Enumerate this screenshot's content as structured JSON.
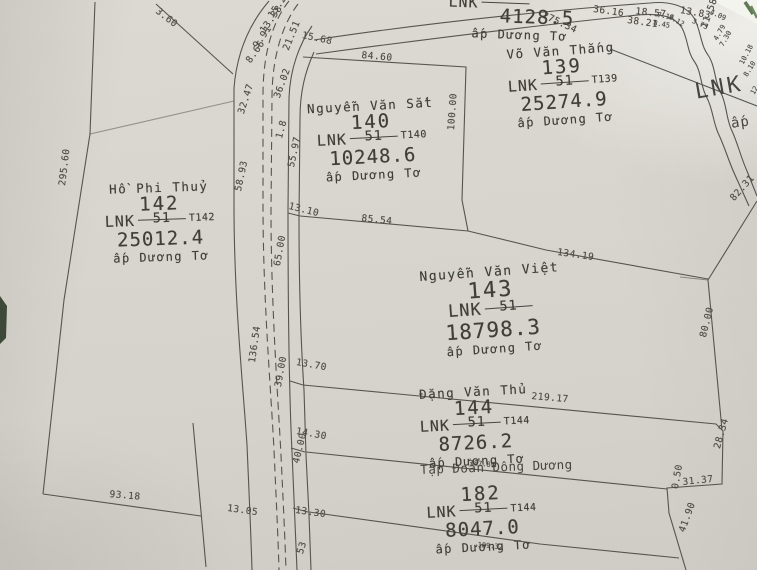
{
  "map": {
    "parcels": [
      {
        "owner": "",
        "number": "",
        "code": "LNK",
        "denom": "",
        "sheet": "",
        "area": "4128.5",
        "hamlet": "ấp Dương Tơ"
      },
      {
        "owner": "Võ Văn Thắng",
        "number": "139",
        "code": "LNK",
        "denom": "51",
        "sheet": "T139",
        "area": "25274.9",
        "hamlet": "ấp Dương Tơ"
      },
      {
        "owner": "Nguyễn Văn Sắt",
        "number": "140",
        "code": "LNK",
        "denom": "51",
        "sheet": "T140",
        "area": "10248.6",
        "hamlet": "ấp Dương Tơ"
      },
      {
        "owner": "Hồ Phi Thuỷ",
        "number": "142",
        "code": "LNK",
        "denom": "51",
        "sheet": "T142",
        "area": "25012.4",
        "hamlet": "ấp Dương Tơ"
      },
      {
        "owner": "Nguyễn Văn Việt",
        "number": "143",
        "code": "LNK",
        "denom": "51",
        "sheet": "",
        "area": "18798.3",
        "hamlet": "ấp Dương Tơ"
      },
      {
        "owner": "Đặng Văn Thủ",
        "number": "144",
        "code": "LNK",
        "denom": "51",
        "sheet": "T144",
        "area": "8726.2",
        "hamlet": "ấp Dương Tơ"
      },
      {
        "owner": "",
        "number": "182",
        "code": "LNK",
        "denom": "51",
        "sheet": "T144",
        "area": "8047.0",
        "hamlet": "ấp Dương Tơ"
      }
    ],
    "stray_labels": [
      {
        "text": "LNK",
        "x": 693,
        "y": 80,
        "r": -10,
        "size": "xl"
      },
      {
        "text": "ấp",
        "x": 730,
        "y": 116,
        "r": -8,
        "size": "l"
      },
      {
        "text": "Tập Đoàn Đông Dương",
        "x": 420,
        "y": 462,
        "r": -2,
        "size": "m"
      }
    ],
    "dimensions": [
      {
        "t": "3.60",
        "x": 160,
        "y": 6,
        "r": 38
      },
      {
        "t": "15.25",
        "x": 266,
        "y": 14,
        "r": -55
      },
      {
        "t": "13.38",
        "x": 258,
        "y": 29,
        "r": -55
      },
      {
        "t": "9.91",
        "x": 251,
        "y": 44,
        "r": -55
      },
      {
        "t": "8.66",
        "x": 244,
        "y": 59,
        "r": -55
      },
      {
        "t": "21.51",
        "x": 281,
        "y": 48,
        "r": -68
      },
      {
        "t": "15.68",
        "x": 303,
        "y": 30,
        "r": 12
      },
      {
        "t": "32.47",
        "x": 236,
        "y": 112,
        "r": -72
      },
      {
        "t": "36.02",
        "x": 272,
        "y": 96,
        "r": -70
      },
      {
        "t": "1.8",
        "x": 274,
        "y": 137,
        "r": -75
      },
      {
        "t": "58.93",
        "x": 233,
        "y": 190,
        "r": -78
      },
      {
        "t": "55.97",
        "x": 286,
        "y": 166,
        "r": -78
      },
      {
        "t": "13.10",
        "x": 290,
        "y": 201,
        "r": 14
      },
      {
        "t": "65.00",
        "x": 272,
        "y": 265,
        "r": -80
      },
      {
        "t": "136.54",
        "x": 247,
        "y": 362,
        "r": -82
      },
      {
        "t": "39.00",
        "x": 273,
        "y": 386,
        "r": -80
      },
      {
        "t": "13.70",
        "x": 297,
        "y": 357,
        "r": 10
      },
      {
        "t": "14.30",
        "x": 297,
        "y": 426,
        "r": 10
      },
      {
        "t": "40.00",
        "x": 291,
        "y": 462,
        "r": -76
      },
      {
        "t": "13.05",
        "x": 228,
        "y": 503,
        "r": 8
      },
      {
        "t": "13.30",
        "x": 296,
        "y": 505,
        "r": 8
      },
      {
        "t": "53",
        "x": 295,
        "y": 552,
        "r": -72
      },
      {
        "t": "93.18",
        "x": 110,
        "y": 489,
        "r": 5
      },
      {
        "t": "295.60",
        "x": 57,
        "y": 185,
        "r": -83
      },
      {
        "t": "84.60",
        "x": 362,
        "y": 50,
        "r": 5
      },
      {
        "t": "100.00",
        "x": 446,
        "y": 130,
        "r": -86
      },
      {
        "t": "85.54",
        "x": 362,
        "y": 213,
        "r": 6
      },
      {
        "t": "134.19",
        "x": 558,
        "y": 247,
        "r": 8
      },
      {
        "t": "82.31",
        "x": 728,
        "y": 196,
        "r": -48
      },
      {
        "t": "80.00",
        "x": 698,
        "y": 336,
        "r": -76
      },
      {
        "t": "219.17",
        "x": 532,
        "y": 391,
        "r": 5
      },
      {
        "t": "187.89",
        "x": 470,
        "y": 459,
        "r": 5,
        "size": "s"
      },
      {
        "t": "28.34",
        "x": 712,
        "y": 447,
        "r": -74
      },
      {
        "t": "31.37",
        "x": 682,
        "y": 477,
        "r": -6
      },
      {
        "t": "0.50",
        "x": 670,
        "y": 488,
        "r": -80
      },
      {
        "t": "41.90",
        "x": 677,
        "y": 530,
        "r": -70
      },
      {
        "t": "189.32",
        "x": 478,
        "y": 541,
        "r": 5,
        "size": "s"
      },
      {
        "t": "36.16",
        "x": 594,
        "y": 4,
        "r": 8
      },
      {
        "t": "18.57",
        "x": 636,
        "y": 6,
        "r": 6
      },
      {
        "t": "13.83",
        "x": 681,
        "y": 5,
        "r": 10
      },
      {
        "t": "38.21",
        "x": 628,
        "y": 15,
        "r": 8
      },
      {
        "t": "275.34",
        "x": 545,
        "y": 10,
        "r": 25
      },
      {
        "t": "11.58",
        "x": 699,
        "y": 26,
        "r": -70
      },
      {
        "t": "4.09",
        "x": 712,
        "y": 8,
        "r": 25,
        "size": "s"
      },
      {
        "t": "7.18",
        "x": 658,
        "y": 11,
        "r": 10,
        "size": "s"
      },
      {
        "t": "9.12",
        "x": 671,
        "y": 13,
        "r": 30,
        "size": "s"
      },
      {
        "t": "3.73",
        "x": 694,
        "y": 17,
        "r": 25,
        "size": "s"
      },
      {
        "t": "8.45",
        "x": 654,
        "y": 19,
        "r": 10,
        "size": "s"
      },
      {
        "t": "4.79",
        "x": 712,
        "y": 38,
        "r": -60,
        "size": "s"
      },
      {
        "t": "7.30",
        "x": 718,
        "y": 44,
        "r": -60,
        "size": "s"
      },
      {
        "t": "10.18",
        "x": 738,
        "y": 62,
        "r": -62,
        "size": "s"
      },
      {
        "t": "8.10",
        "x": 742,
        "y": 74,
        "r": -58,
        "size": "s"
      },
      {
        "t": "12",
        "x": 749,
        "y": 92,
        "r": -60,
        "size": "s"
      }
    ]
  }
}
